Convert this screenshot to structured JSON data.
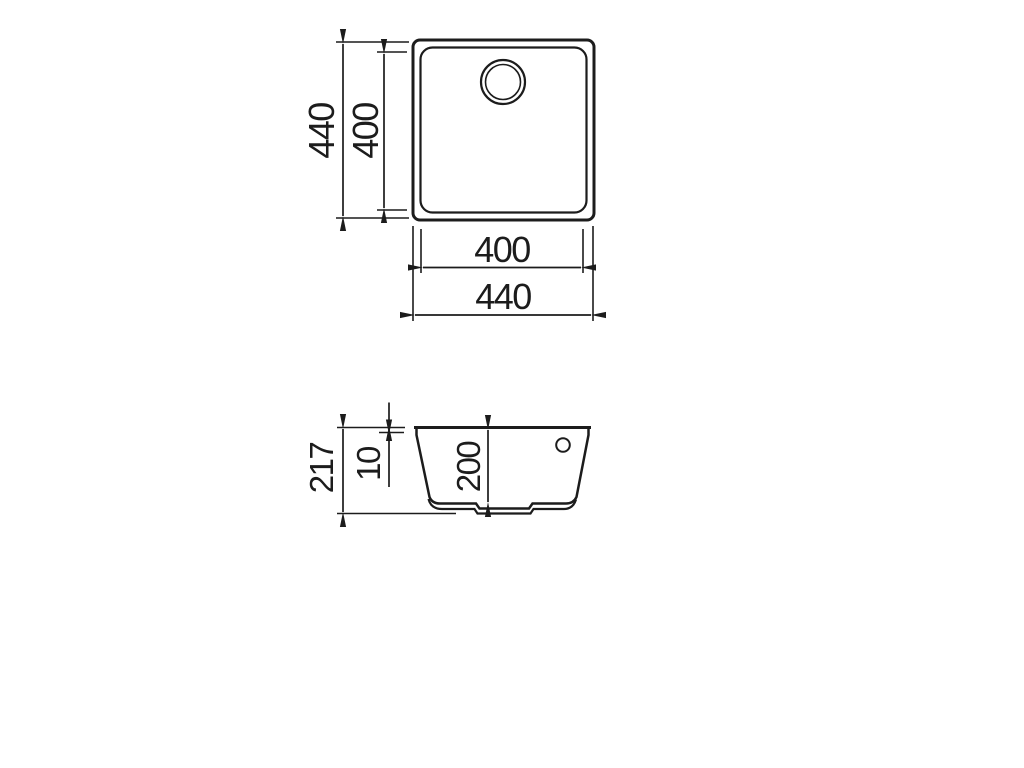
{
  "drawing": {
    "subject": "undermount sink dimension drawing",
    "background_color": "#ffffff",
    "line_color": "#1c1c1c",
    "views": {
      "top": {
        "name": "top view",
        "outer_width_mm": "440",
        "outer_height_mm": "440",
        "inner_width_mm": "400",
        "inner_height_mm": "400",
        "feature": "drain-hole"
      },
      "section": {
        "name": "front section view",
        "total_depth_mm": "217",
        "rim_thickness_mm": "10",
        "bowl_depth_mm": "200",
        "feature": "overflow-hole"
      }
    }
  }
}
